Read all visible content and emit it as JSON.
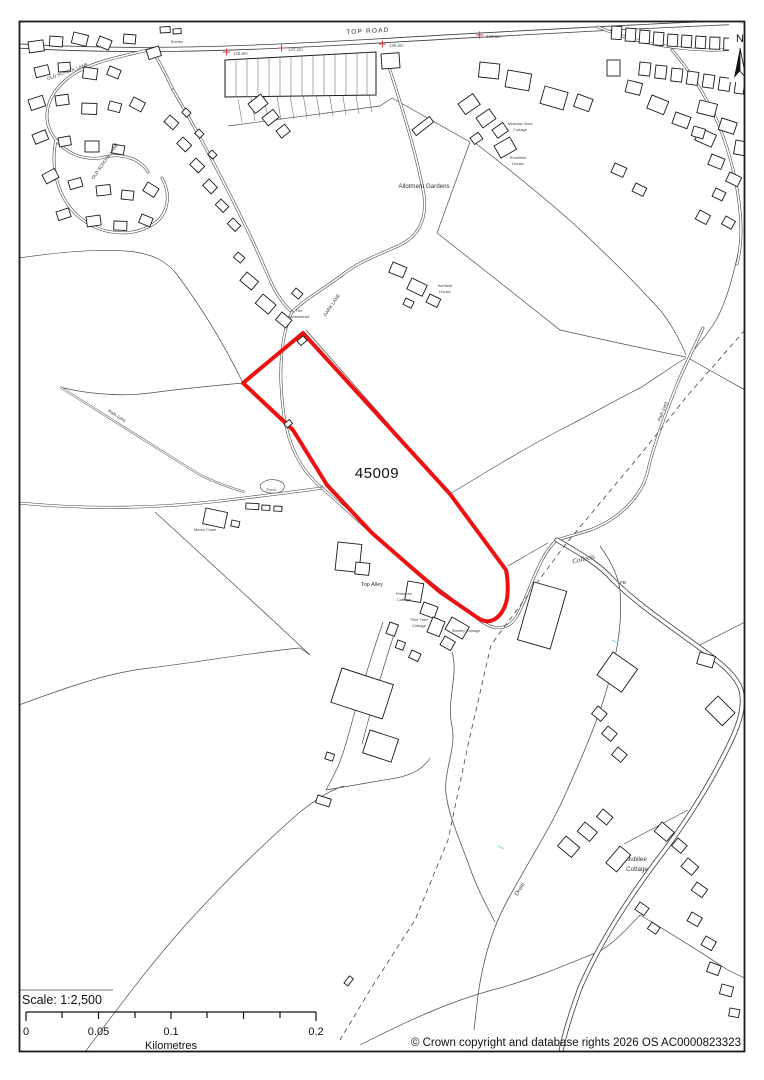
{
  "map": {
    "region_labels": {
      "top_road": "TOP ROAD",
      "old_school_lane_1": "OLD SCHOOL LANE",
      "old_school_lane_2": "OLD SCHOOL LANE",
      "shelter": "Shelter",
      "allotment_gardens": "Allotment Gardens",
      "dark_lane": "DARK LANE",
      "homestead_1": "The",
      "homestead_2": "Homestead",
      "meadow_view_1": "Meadow View",
      "meadow_view_2": "Cottage",
      "rosefield_1": "Rosefield",
      "rosefield_2": "House",
      "ashfield_1": "Ashfield",
      "ashfield_2": "House",
      "path_um_left": "Path (um)",
      "path_um_right": "Path (um)",
      "pond": "Pond",
      "moors_close": "Moors Close",
      "top_alley": "Top Alley",
      "primrose_1": "Primrose",
      "primrose_2": "Cottage",
      "pine_tree_1": "Pine Tree",
      "pine_tree_2": "Cottage",
      "stanley_cottage": "Stanley Cottage",
      "collects": "Collects",
      "fb": "FB",
      "jubilee_1": "Jubilee",
      "jubilee_2": "Cottage",
      "drain": "Drain"
    },
    "parcel": {
      "id": "45009",
      "outline_color": "#ee1111"
    },
    "benchmarks": [
      "126.8m",
      "127.2m",
      "135.6m",
      "138.8m"
    ],
    "benchmark_cross_color": "#cc4444",
    "north_arrow": {
      "label": "N"
    }
  },
  "scale_bar": {
    "scale_text": "Scale: 1:2,500",
    "tick_labels": [
      "0",
      "0.05",
      "0.1",
      "0.2"
    ],
    "unit_label": "Kilometres"
  },
  "footer": {
    "copyright": "© Crown copyright and database rights 2026 OS AC0000823323"
  }
}
